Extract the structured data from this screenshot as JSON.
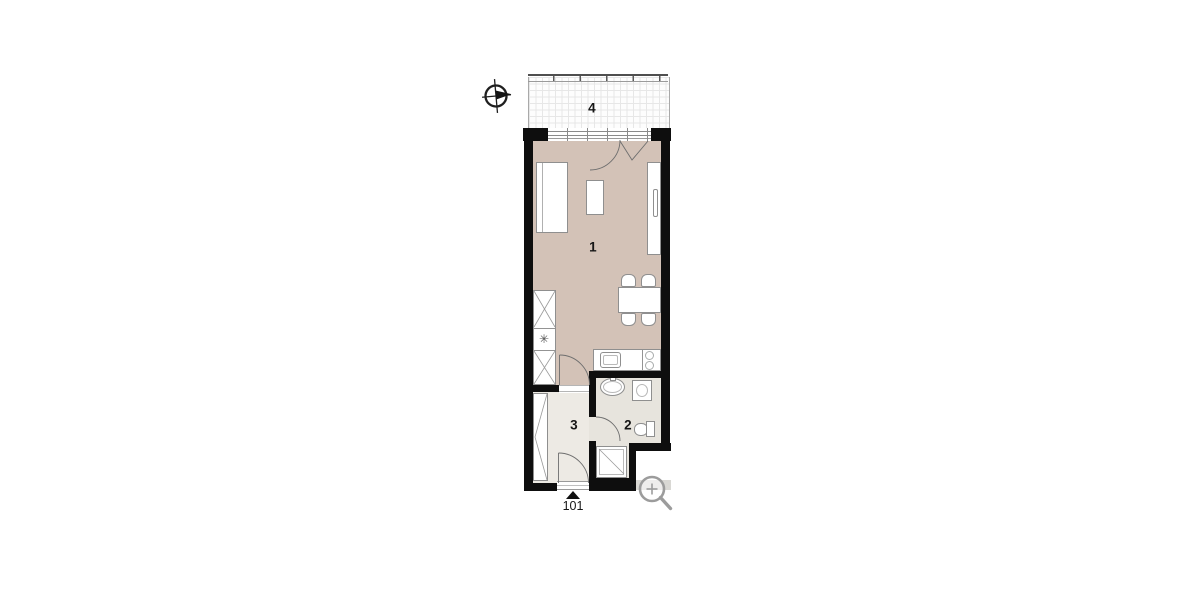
{
  "title": "apartment unit floor plan",
  "plan": {
    "unit_number": "101",
    "rooms": [
      {
        "id": "living-room",
        "label": "1"
      },
      {
        "id": "bathroom",
        "label": "2"
      },
      {
        "id": "hallway",
        "label": "3"
      },
      {
        "id": "balcony",
        "label": "4"
      }
    ],
    "symbols": {
      "appliance_marker": "✳"
    }
  },
  "icons": {
    "compass": "north-compass-icon",
    "magnifier": "zoom-magnifier-icon"
  },
  "colors": {
    "wall": "#0e0e0e",
    "floor_living": "#d3c2b7",
    "floor_hall": "#edeae4",
    "floor_bath": "#e7e4dd",
    "furniture_stroke": "#8f8f8f",
    "exterior_paving": "#d9d8d4",
    "icon_gray": "#9c9c9c"
  }
}
